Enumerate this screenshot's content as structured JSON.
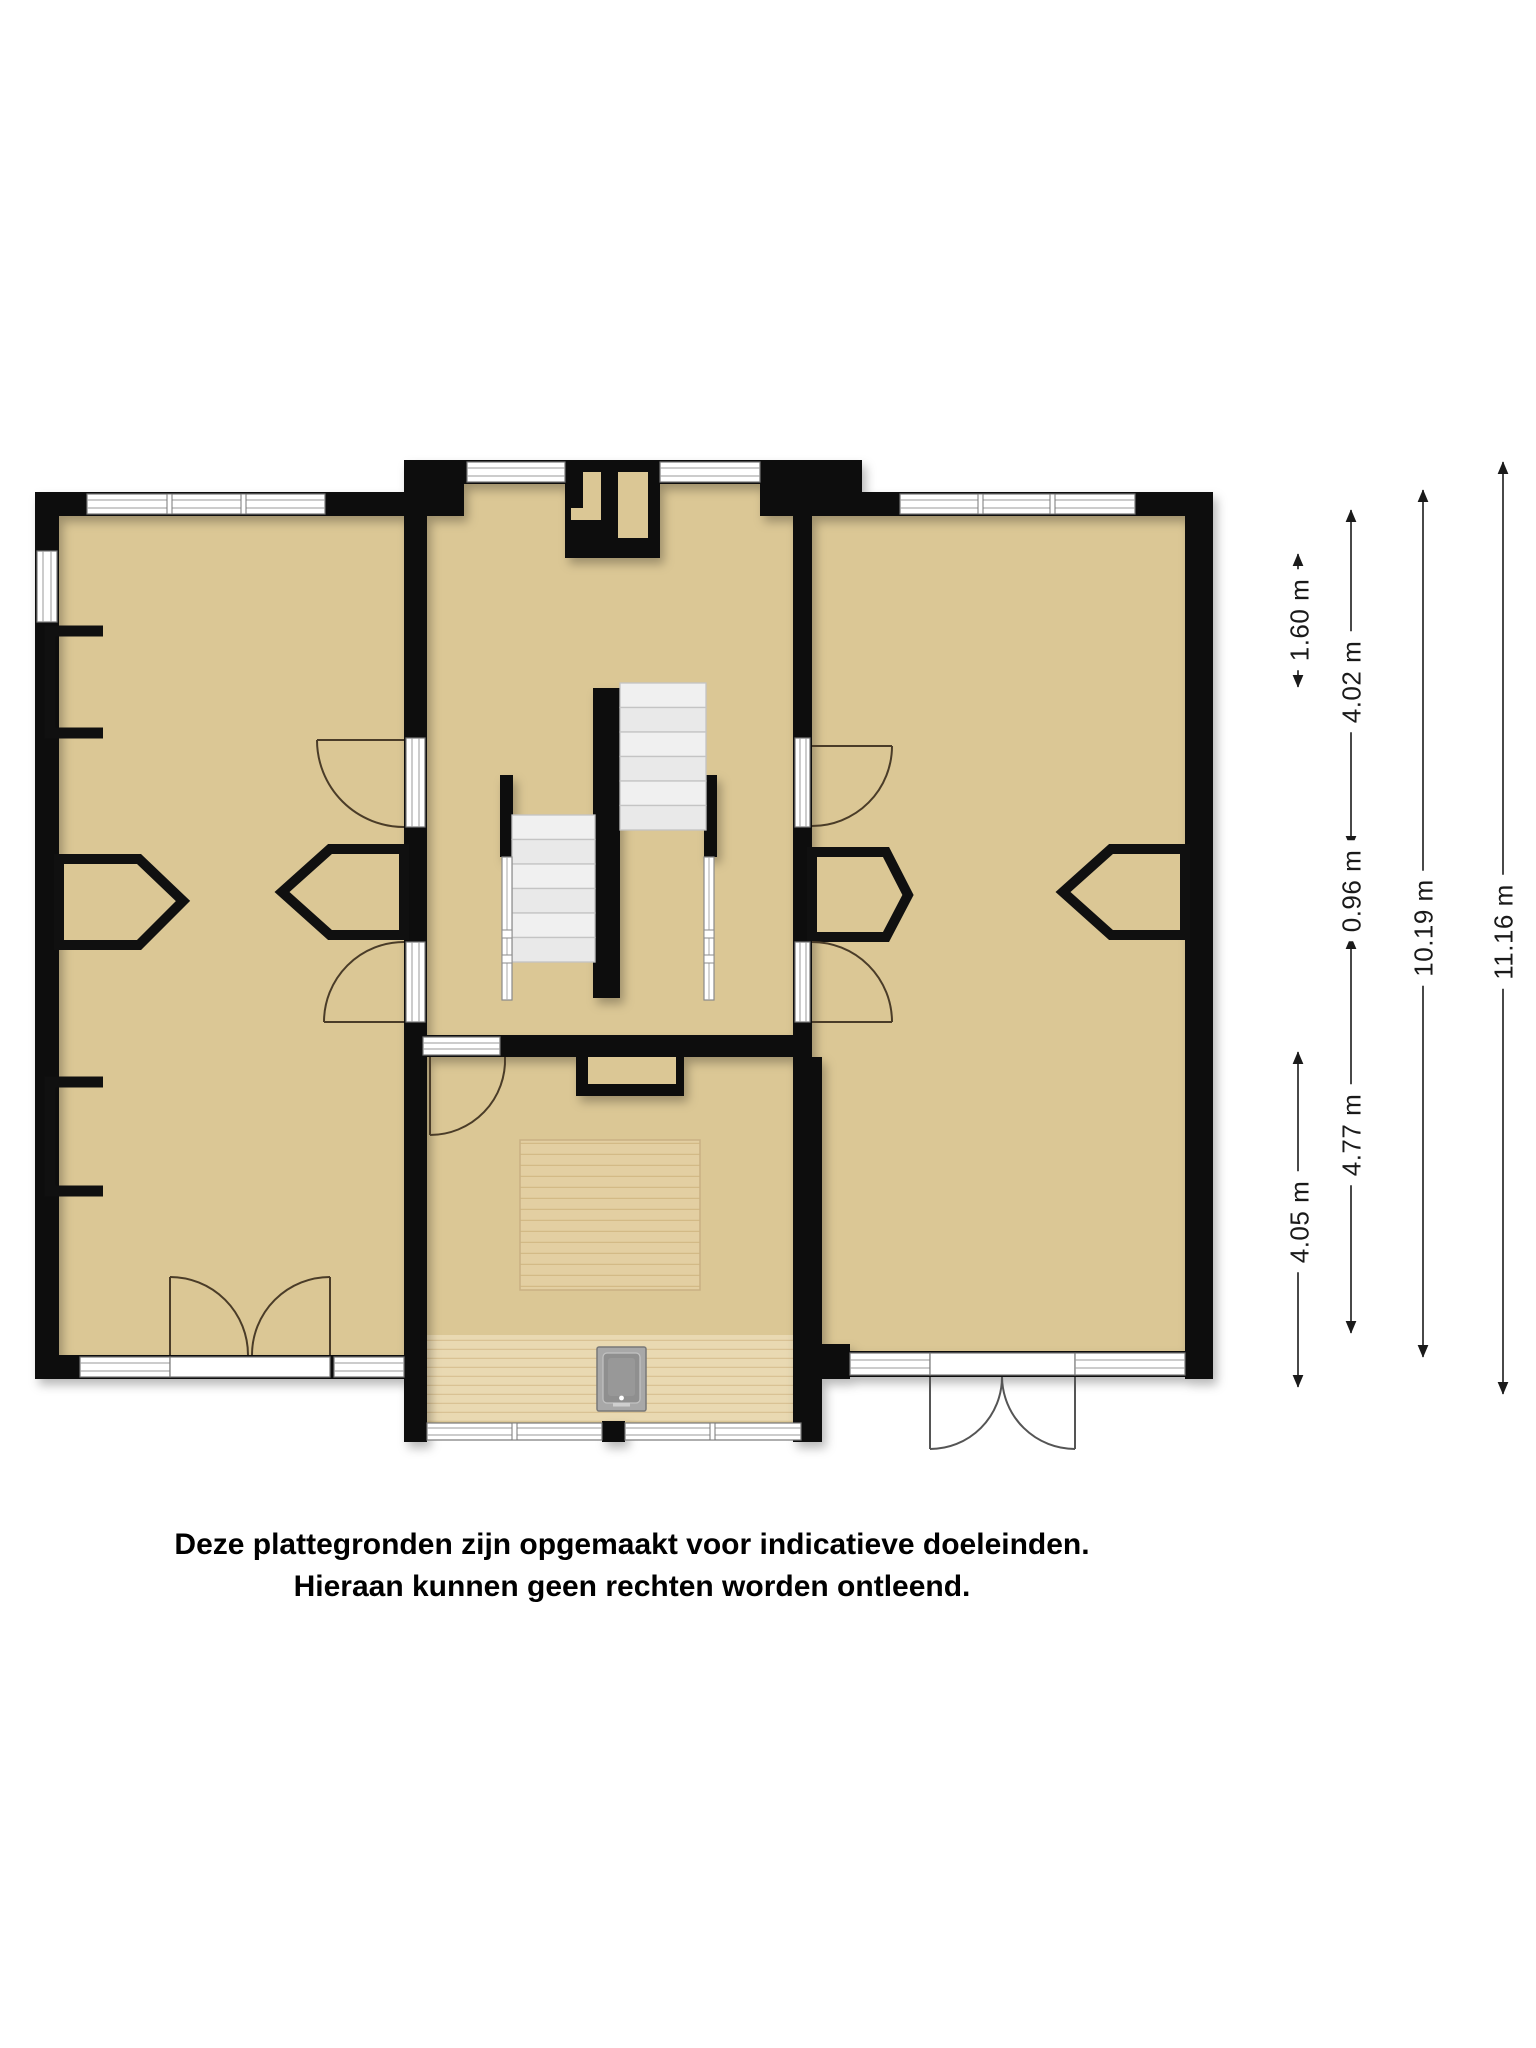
{
  "plan": {
    "type": "floorplan",
    "floor_color": "#dbc795",
    "wall_color": "#101010",
    "wood_color": "#e9d9b2",
    "stair_color": "#ededed",
    "dimension_color": "#1a1a1a",
    "objects": [
      "stove-icon",
      "dining-table",
      "stairs",
      "chimney",
      "bay-niche"
    ]
  },
  "dimensions": [
    {
      "label": "1.60 m"
    },
    {
      "label": "4.05 m"
    },
    {
      "label": "4.02 m"
    },
    {
      "label": "0.96 m"
    },
    {
      "label": "4.77 m"
    },
    {
      "label": "10.19 m"
    },
    {
      "label": "11.16 m"
    }
  ],
  "disclaimer": {
    "line1": "Deze plattegronden zijn opgemaakt voor indicatieve doeleinden.",
    "line2": "Hieraan kunnen geen rechten worden ontleend."
  }
}
